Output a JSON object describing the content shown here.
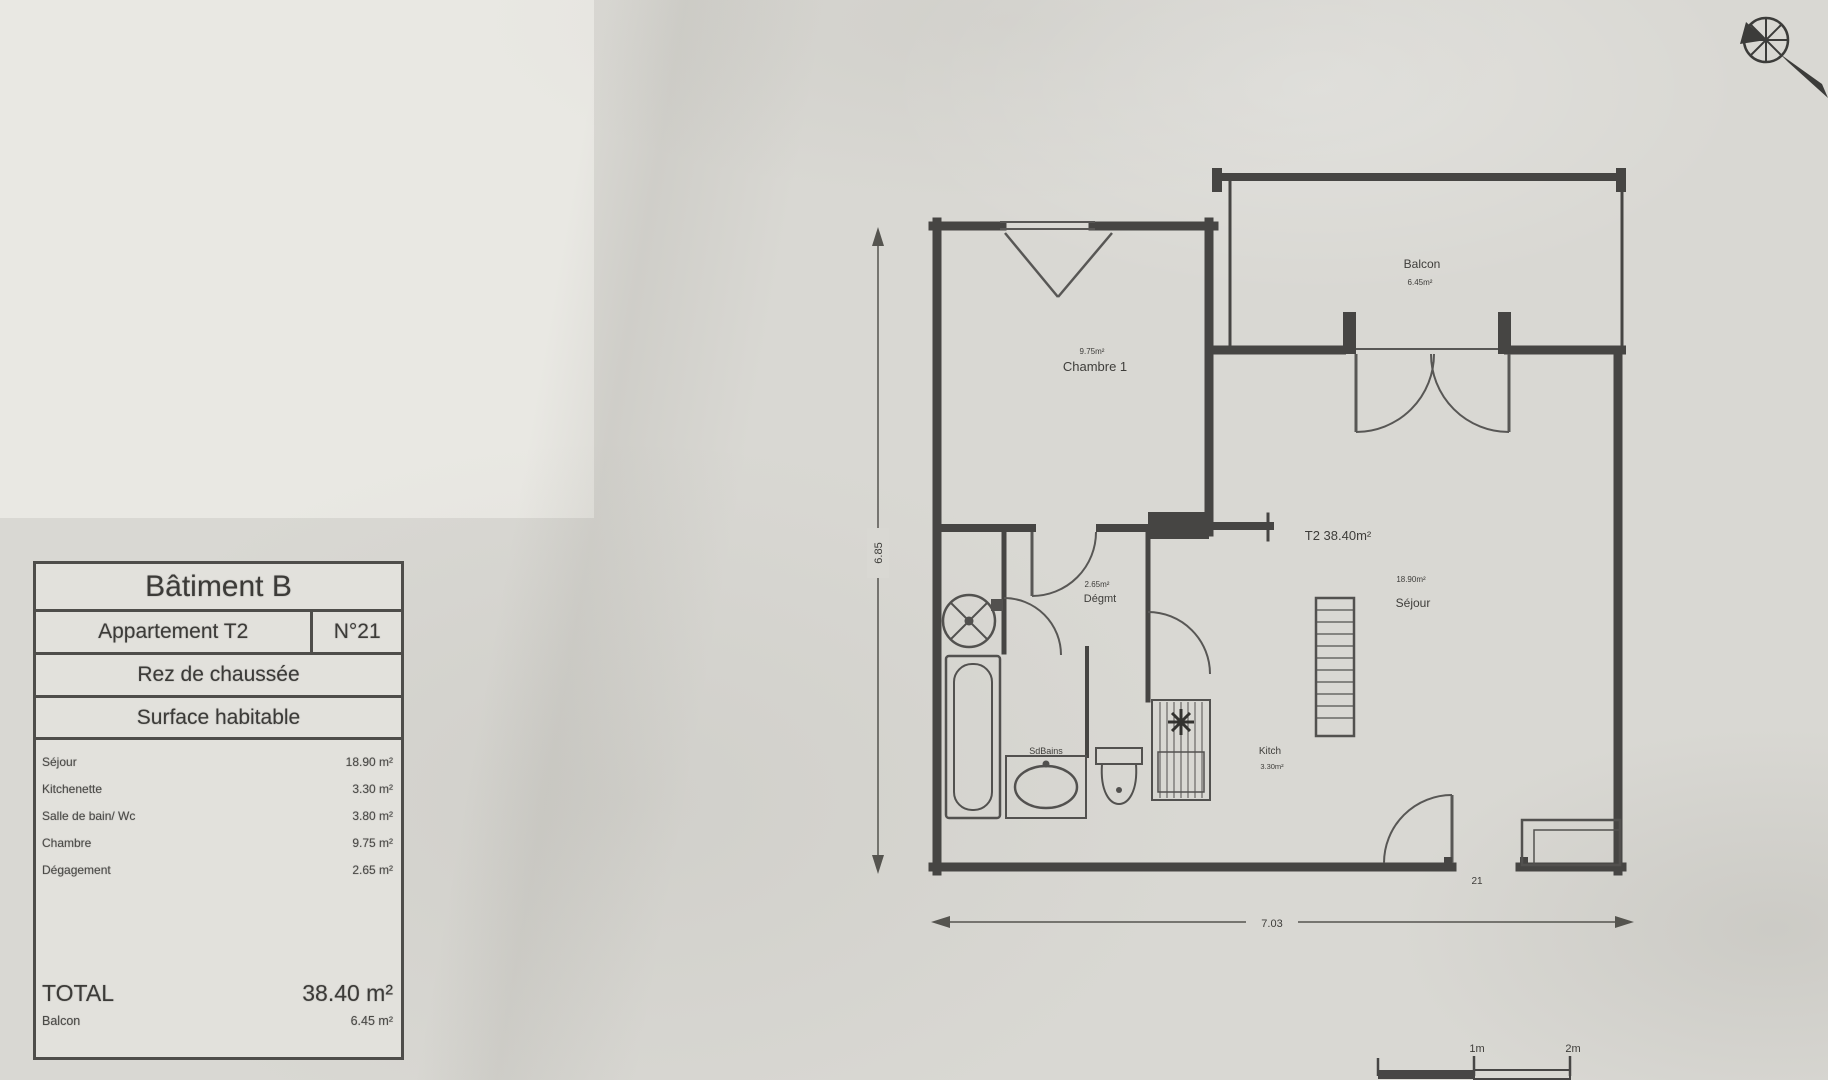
{
  "document": {
    "info_table": {
      "building": "Bâtiment B",
      "apartment_type": "Appartement T2",
      "apartment_number": "N°21",
      "floor": "Rez de chaussée",
      "surface_header": "Surface habitable",
      "rooms": [
        {
          "label": "Séjour",
          "area": "18.90 m²"
        },
        {
          "label": "Kitchenette",
          "area": "3.30 m²"
        },
        {
          "label": "Salle de bain/ Wc",
          "area": "3.80 m²"
        },
        {
          "label": "Chambre",
          "area": "9.75 m²"
        },
        {
          "label": "Dégagement",
          "area": "2.65 m²"
        }
      ],
      "total_label": "TOTAL",
      "total_value": "38.40 m²",
      "balcony_label": "Balcon",
      "balcony_value": "6.45 m²"
    },
    "plan": {
      "unit_label": "T2 38.40m²",
      "rooms": {
        "chambre": {
          "area": "9.75m²",
          "name": "Chambre 1"
        },
        "balcon": {
          "name": "Balcon",
          "area": "6.45m²"
        },
        "sejour": {
          "area": "18.90m²",
          "name": "Séjour"
        },
        "degagement": {
          "area": "2.65m²",
          "name": "Dégmt"
        },
        "salle_de_bains": {
          "name": "SdBains"
        },
        "kitchenette": {
          "name": "Kitch",
          "area": "3.30m²"
        }
      },
      "door_number": "21",
      "dim_height": "6.85",
      "dim_width": "7.03",
      "scale": {
        "one": "1m",
        "two": "2m"
      }
    }
  }
}
